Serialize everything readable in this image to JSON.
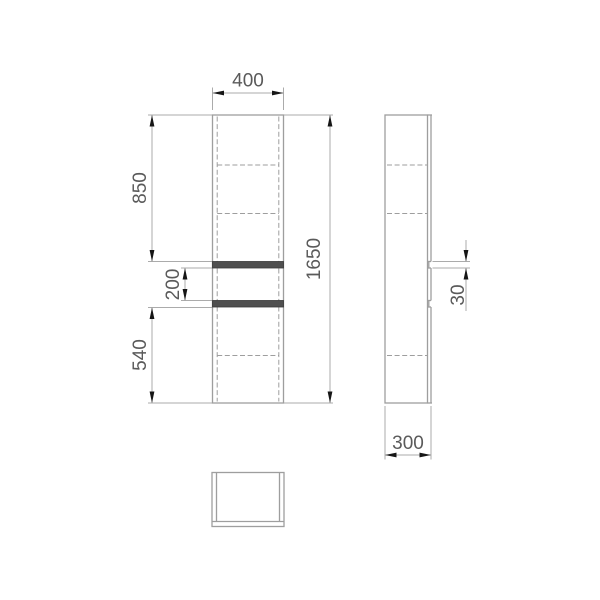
{
  "drawing": {
    "type": "furniture-technical-drawing",
    "subject": "tall two-door cabinet, orthographic projections (front, side, top)",
    "views": {
      "front": {
        "name": "front-view",
        "dimensions": {
          "width": "400",
          "height": "1650",
          "upper_door_height": "850",
          "handle_spacing": "200",
          "lower_door_height": "540"
        }
      },
      "side": {
        "name": "side-view",
        "dimensions": {
          "depth": "300",
          "handle_recess_height": "30"
        }
      },
      "top": {
        "name": "top-view"
      }
    },
    "colors": {
      "outline": "#9e9e9e",
      "dimension_line": "#ababab",
      "arrow": "#161616",
      "text": "#5a5a5a",
      "handle_fill": "#4f4f4f",
      "handle_stroke": "#383838",
      "background": "#ffffff"
    }
  }
}
